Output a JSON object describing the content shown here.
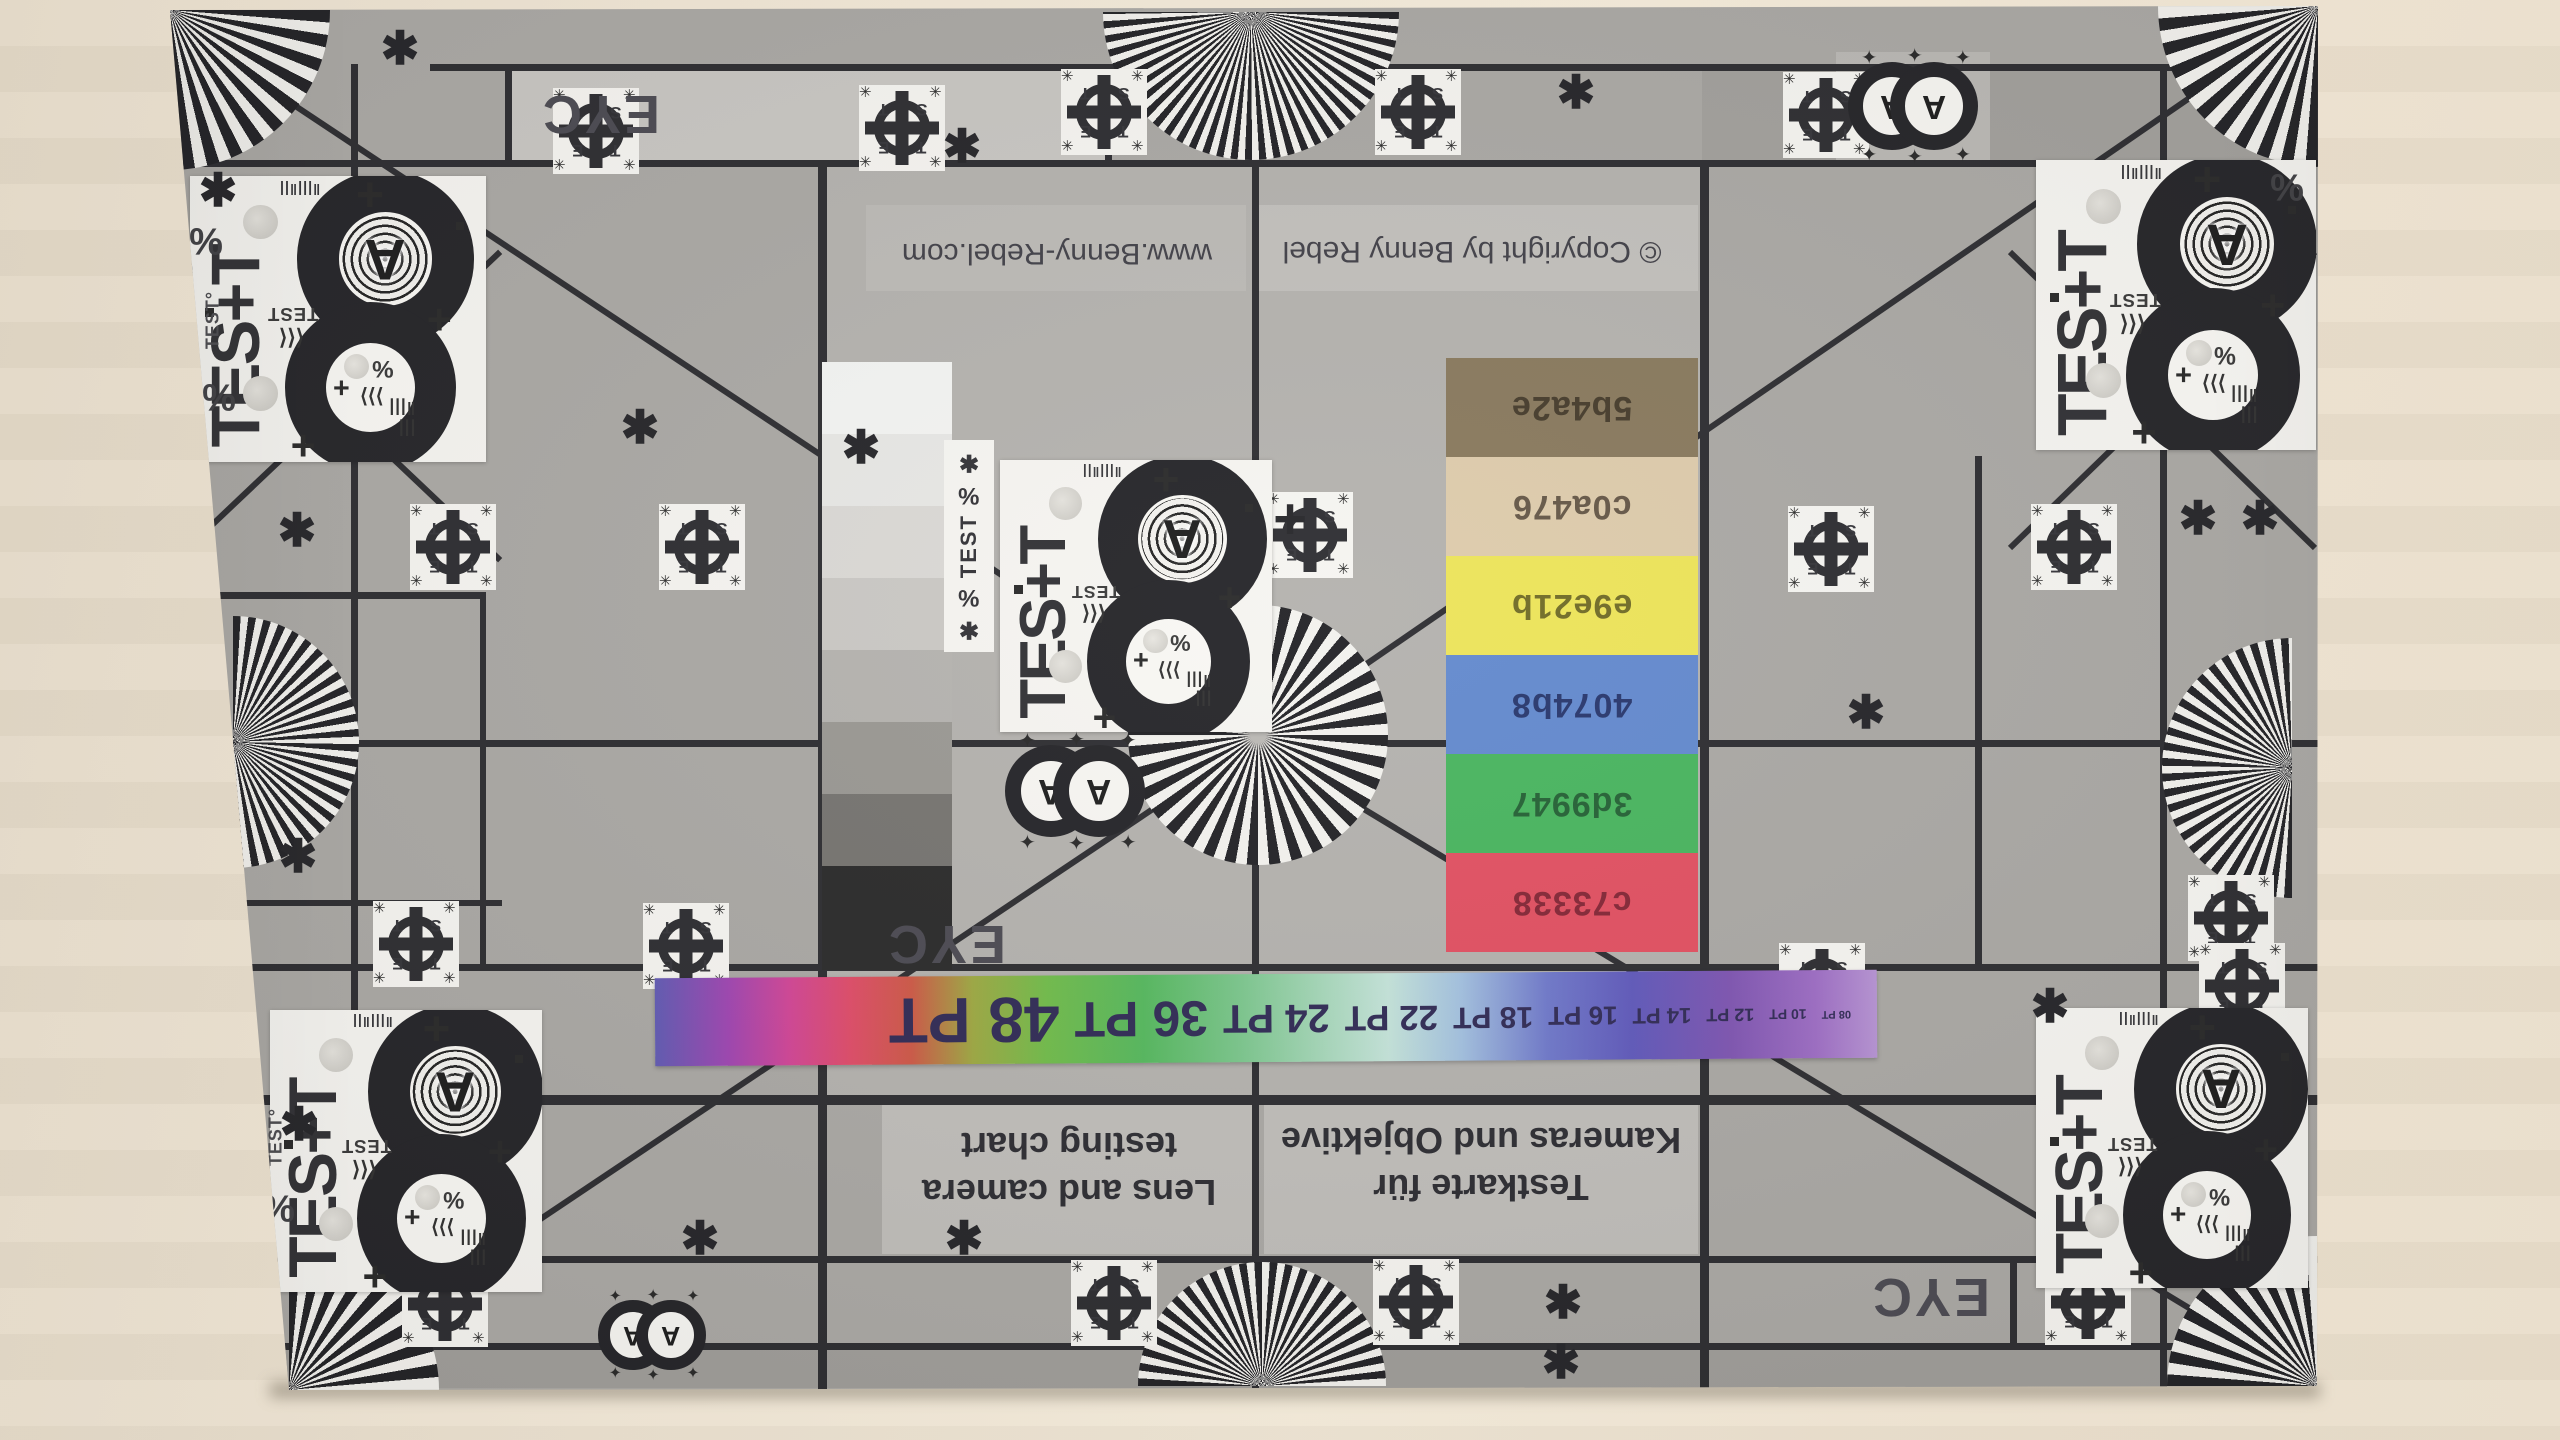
{
  "scene": {
    "type": "photograph",
    "subject": "lens and camera test chart taped to a wall, photographed upside down"
  },
  "wall": {
    "base_color": "#e9dfcd",
    "right_color": "#f0e7d6",
    "bottom_color": "#e8ddca"
  },
  "chart": {
    "base_color": "#a7a5a1",
    "line_color": "#26262a",
    "chip_bg": "#f5f4f0",
    "texts": {
      "eyc": "EYC",
      "url": "www.Benny-Rebel.com",
      "copyright": "© Copyright by Benny Rebel",
      "title_de_line1": "Testkarte für",
      "title_de_line2": "Kameras und Objektive",
      "title_en_line1": "Lens and camera",
      "title_en_line2": "testing chart"
    },
    "pt_scale": {
      "labels_as_printed": [
        "48 PT",
        "36 PT",
        "24 PT",
        "22 PT",
        "18 PT",
        "16 PT",
        "14 PT",
        "12 PT",
        "10 PT",
        "08 PT"
      ],
      "text_color": "#2a2450"
    },
    "color_patches": [
      {
        "label": "5b4a2e",
        "fill": "#847457",
        "label_color": "#3f3524"
      },
      {
        "label": "c0a476",
        "fill": "#dcc9a8",
        "label_color": "#5f5140"
      },
      {
        "label": "e9e21b",
        "fill": "#ece353",
        "label_color": "#6b661e"
      },
      {
        "label": "4074b8",
        "fill": "#5d85cc",
        "label_color": "#203068"
      },
      {
        "label": "3d9947",
        "fill": "#42b259",
        "label_color": "#1d5c2e"
      },
      {
        "label": "c73338",
        "fill": "#e04a5c",
        "label_color": "#801f2f"
      }
    ],
    "grayscale_steps": [
      "#f2f3f1",
      "#e6e6e3",
      "#d9d7d3",
      "#c8c6c2",
      "#b2b0ac",
      "#96948f",
      "#716f6b",
      "#232323"
    ],
    "chip": {
      "word": "TES+T",
      "mini_word": "TEST",
      "letter": "A",
      "chevrons_r": "⟩⟩⟩",
      "chevrons_l": "⟨⟨⟨",
      "percent": "%",
      "plus": "+"
    },
    "crosshair": {
      "letters": [
        "T",
        "S",
        "E",
        "T"
      ],
      "corner_glyph": "✳"
    },
    "strip_chip": [
      "✱",
      "%",
      "TEST",
      "%",
      "✱"
    ],
    "glyphs": {
      "asterisk": "✱",
      "percent": "%",
      "plus": "+",
      "star": "✦"
    }
  }
}
